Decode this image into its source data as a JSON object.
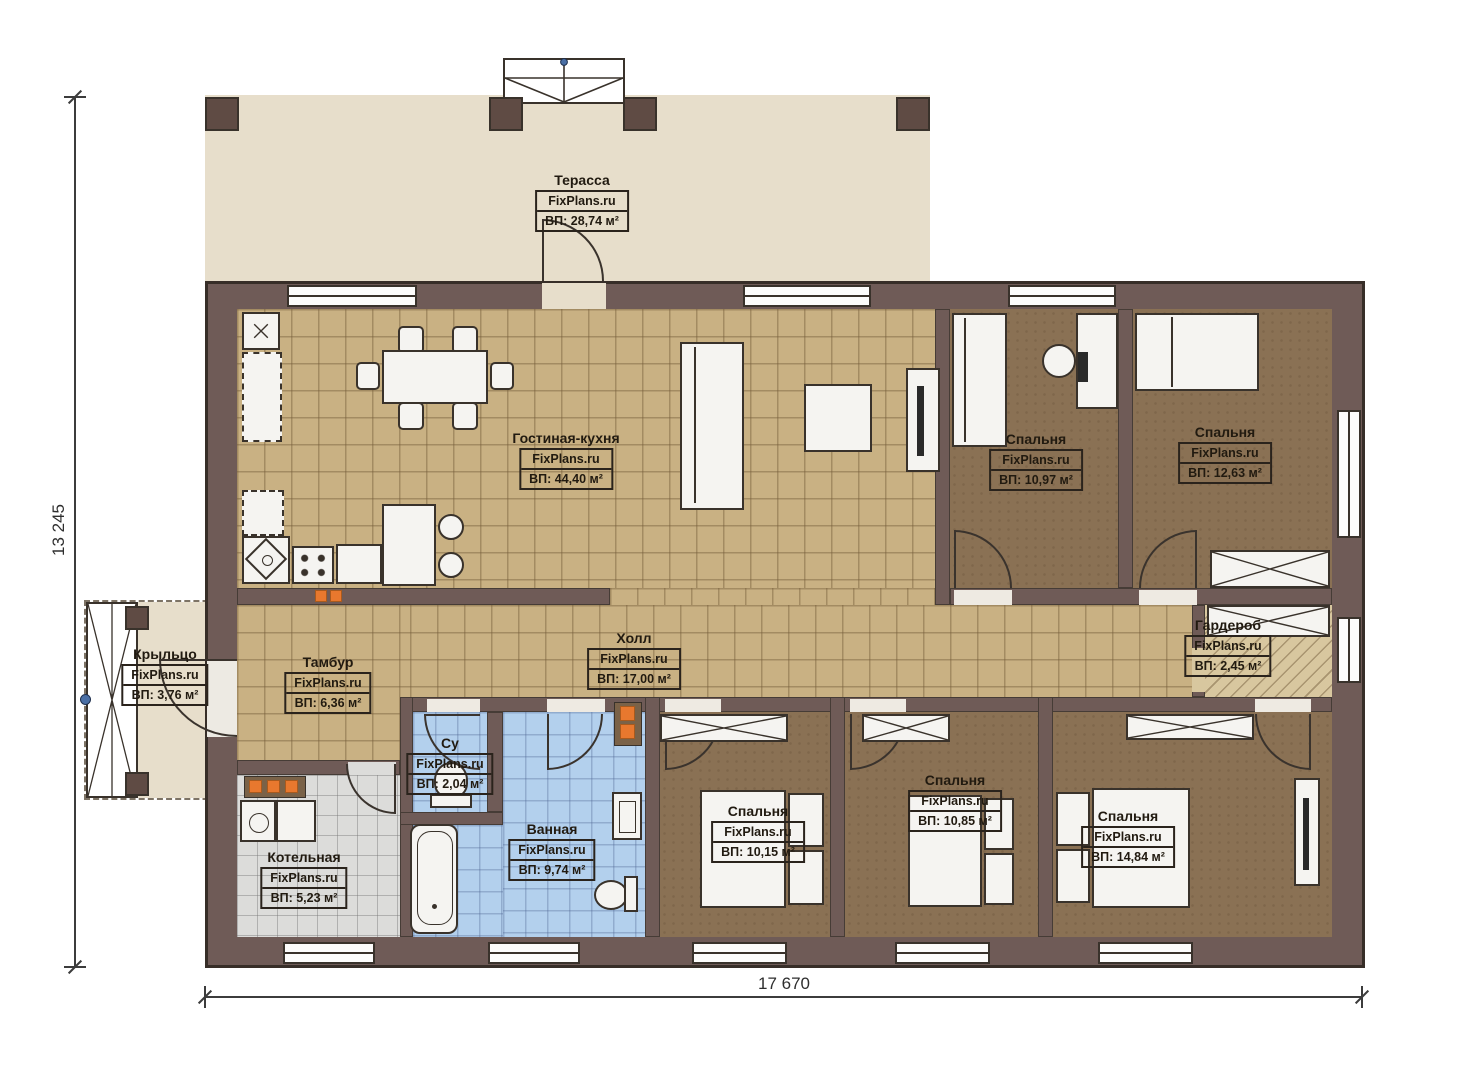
{
  "watermark": "FixPlans.ru",
  "dimensions": {
    "width_label": "17 670",
    "height_label": "13 245"
  },
  "rooms": [
    {
      "name": "Терасса",
      "area": "ВП: 28,74 м²"
    },
    {
      "name": "Гостиная-кухня",
      "area": "ВП: 44,40 м²"
    },
    {
      "name": "Спальня",
      "area": "ВП: 10,97 м²"
    },
    {
      "name": "Спальня",
      "area": "ВП: 12,63 м²"
    },
    {
      "name": "Крыльцо",
      "area": "ВП: 3,76 м²"
    },
    {
      "name": "Тамбур",
      "area": "ВП: 6,36 м²"
    },
    {
      "name": "Холл",
      "area": "ВП: 17,00 м²"
    },
    {
      "name": "Гардероб",
      "area": "ВП: 2,45 м²"
    },
    {
      "name": "Су",
      "area": "ВП: 2,04 м²"
    },
    {
      "name": "Ванная",
      "area": "ВП: 9,74 м²"
    },
    {
      "name": "Котельная",
      "area": "ВП: 5,23 м²"
    },
    {
      "name": "Спальня",
      "area": "ВП: 10,15 м²"
    },
    {
      "name": "Спальня",
      "area": "ВП: 10,85 м²"
    },
    {
      "name": "Спальня",
      "area": "ВП: 14,84 м²"
    }
  ],
  "colors": {
    "wall": "#6f5b57",
    "accent_orange": "#e8782e",
    "tile_tan": "#c9b183",
    "tile_blue": "#b3d0ed",
    "floor_brown": "#8a7154",
    "terrace_beige": "#e7decb"
  }
}
